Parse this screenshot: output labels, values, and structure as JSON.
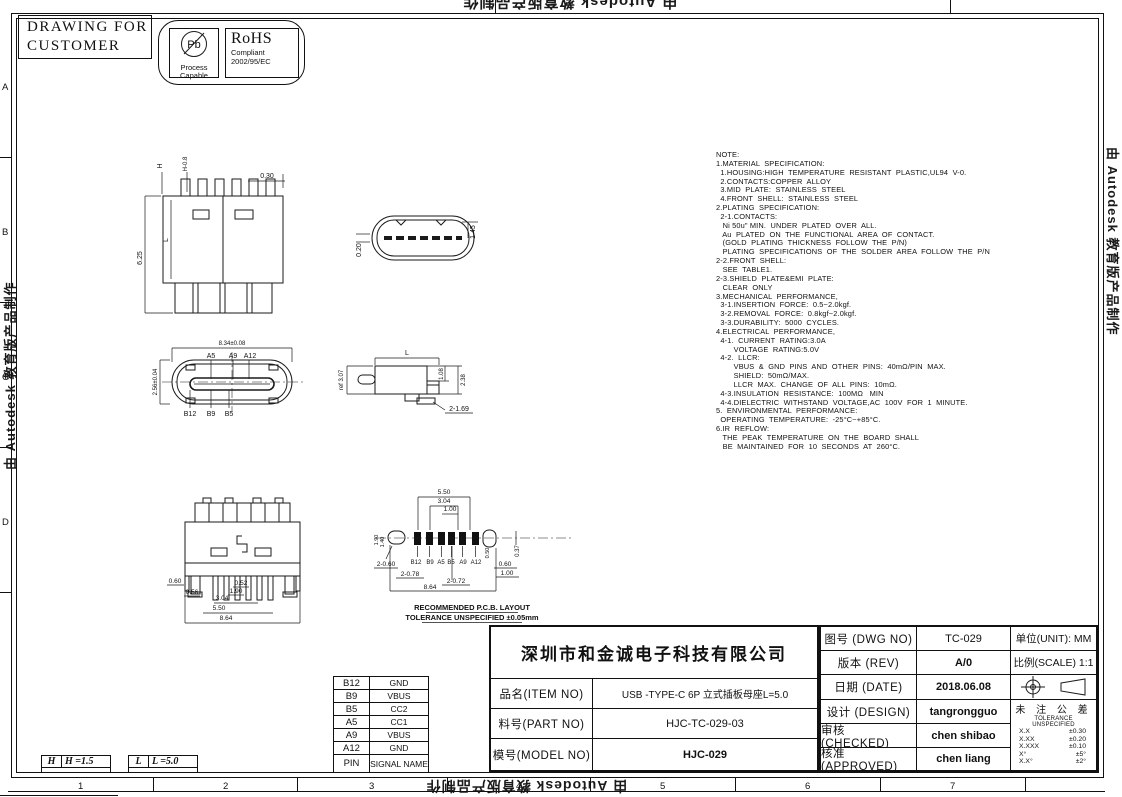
{
  "watermark": "由 Autodesk 教育版产品制作",
  "stamp": {
    "line1": "DRAWING FOR",
    "line2": "CUSTOMER",
    "pb_symbol": "Pb",
    "pb_line1": "Process",
    "pb_line2": "Capable",
    "rohs_title": "RoHS",
    "rohs_line1": "Compliant",
    "rohs_line2": "2002/95/EC"
  },
  "notes": "NOTE:\n1.MATERIAL  SPECIFICATION:\n  1.HOUSING:HIGH  TEMPERATURE  RESISTANT  PLASTIC,UL94  V-0.\n  2.CONTACTS:COPPER  ALLOY\n  3.MID  PLATE:  STAINLESS  STEEL\n  4.FRONT  SHELL:  STAINLESS  STEEL\n2.PLATING  SPECIFICATION:\n  2-1.CONTACTS:\n   Ni 50u\" MIN.  UNDER  PLATED  OVER  ALL.\n   Au  PLATED  ON  THE  FUNCTIONAL  AREA  OF  CONTACT.\n   (GOLD  PLATING  THICKNESS  FOLLOW  THE  P/N)\n   PLATING  SPECIFICATIONS  OF  THE  SOLDER  AREA  FOLLOW  THE  P/N\n2-2.FRONT  SHELL:\n   SEE  TABLE1.\n2-3.SHIELD  PLATE&EMI  PLATE:\n   CLEAR  ONLY\n3.MECHANICAL  PERFORMANCE,\n  3-1.INSERTION  FORCE:  0.5~2.0kgf.\n  3-2.REMOVAL  FORCE:  0.8kgf~2.0kgf.\n  3-3.DURABILITY:  5000  CYCLES.\n4.ELECTRICAL  PERFORMANCE,\n  4-1.  CURRENT  RATING:3.0A\n        VOLTAGE  RATING:5.0V\n  4-2.  LLCR:\n        VBUS  &  GND  PINS  AND  OTHER  PINS:  40mΩ/PIN  MAX.\n        SHIELD:  50mΩ/MAX.\n        LLCR  MAX.  CHANGE  OF  ALL  PINS:  10mΩ.\n  4-3.INSULATION  RESISTANCE:  100MΩ   MIN\n  4-4.DIELECTRIC  WITHSTAND  VOLTAGE,AC  100V  FOR  1  MINUTE.\n5.  ENVIRONMENTAL  PERFORMANCE:\n  OPERATING  TEMPERATURE:  -25°C~+85°C.\n6.IR  REFLOW:\n   THE  PEAK  TEMPERATURE  ON  THE  BOARD  SHALL\n   BE  MAINTAINED  FOR  10  SECONDS  AT  260°C.",
  "views": {
    "front": {
      "h": "H",
      "h2": "H-0.8",
      "t030": "0.30",
      "t625": "6.25",
      "tl": "L"
    },
    "plug": {
      "t020": "0.20",
      "t145": "1.45"
    },
    "face": {
      "t834": "8.34±0.08",
      "t256": "2.56±0.04",
      "a5": "A5",
      "a9": "A9",
      "a12": "A12",
      "b12": "B12",
      "b9": "B9",
      "b5": "B5"
    },
    "side": {
      "tl": "L",
      "ref": "ref 3.07",
      "t108": "1.08",
      "t238": "2.38",
      "t169": "2-1.69"
    },
    "front2": {
      "d1": "0.60",
      "d2": "0.56",
      "d3": "0.52",
      "d4": "1.90",
      "d5": "3.04",
      "d6": "5.50",
      "d7": "8.64"
    },
    "pcb": {
      "t550": "5.50",
      "t304": "3.04",
      "t100": "1.00",
      "t190": "1.90",
      "t140": "1.40",
      "b12": "B12",
      "b9": "B9",
      "a5": "A5",
      "b5": "B5",
      "a9": "A9",
      "a12": "A12",
      "t2060": "2-0.60",
      "t2078": "2-0.78",
      "t2072": "2-0.72",
      "t864": "8.64",
      "t060": "0.60",
      "t100r": "1.00",
      "t050": "0.50",
      "t037": "0.37",
      "cap1": "RECOMMENDED  P.C.B. LAYOUT",
      "cap2": "TOLERANCE  UNSPECIFIED  ±0.05mm"
    }
  },
  "pin_table": {
    "rows": [
      {
        "pin": "B12",
        "signal": "GND"
      },
      {
        "pin": "B9",
        "signal": "VBUS"
      },
      {
        "pin": "B5",
        "signal": "CC2"
      },
      {
        "pin": "A5",
        "signal": "CC1"
      },
      {
        "pin": "A9",
        "signal": "VBUS"
      },
      {
        "pin": "A12",
        "signal": "GND"
      },
      {
        "pin": "PIN",
        "signal": "SIGNAL NAME"
      }
    ]
  },
  "hl_boxes": {
    "h_key": "H",
    "h_val": "H =1.5",
    "l_key": "L",
    "l_val": "L =5.0"
  },
  "title_block": {
    "company": "深圳市和金诚电子科技有限公司",
    "item_label": "品名(ITEM NO)",
    "item_value": "USB -TYPE-C 6P 立式插板母座L=5.0",
    "part_label": "料号(PART NO)",
    "part_value": "HJC-TC-029-03",
    "model_label": "模号(MODEL NO)",
    "model_value": "HJC-029",
    "dwg_label": "图号 (DWG NO)",
    "dwg_value": "TC-029",
    "rev_label": "版本 (REV)",
    "rev_value": "A/0",
    "date_label": "日期 (DATE)",
    "date_value": "2018.06.08",
    "design_label": "设计 (DESIGN)",
    "design_value": "tangrongguo",
    "checked_label": "审核 (CHECKED)",
    "checked_value": "chen shibao",
    "approved_label": "核准 (APPROVED)",
    "approved_value": "chen liang",
    "unit_label": "单位(UNIT): MM",
    "scale_label": "比例(SCALE) 1:1",
    "tol_title": "未 注 公 差",
    "tol_subtitle": "TOLERANCE UNSPECIFIED",
    "tol_rows": [
      [
        "X.X",
        "±0.30"
      ],
      [
        "X.XX",
        "±0.20"
      ],
      [
        "X.XXX",
        "±0.10"
      ],
      [
        "X°",
        "±5°"
      ],
      [
        "X.X°",
        "±2°"
      ]
    ]
  },
  "zones": {
    "bottom": [
      "1",
      "2",
      "3",
      "4",
      "5",
      "6",
      "7"
    ],
    "left": [
      "A",
      "B",
      "C",
      "D"
    ]
  }
}
